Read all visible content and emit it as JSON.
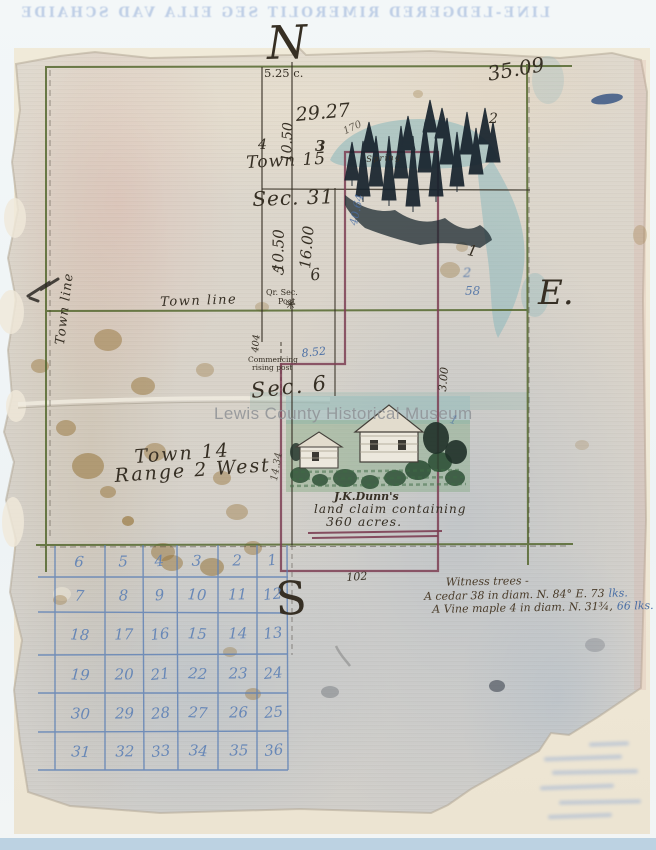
{
  "scan": {
    "watermark": "Lewis County Historical Museum",
    "bleedthrough_text": "LINE-LEDGERED RIMEROLIT SEG ELLA VAD SCHAIDE"
  },
  "colors": {
    "paper": "#d8d2c8",
    "township_line": "#55682f",
    "ink": "#362f24",
    "claim_line": "#7c3e53",
    "blue_annotation": "#4a6fa5",
    "grid_blue": "#5b7fb5",
    "watercolor": "#7fb3ba",
    "stain": "#96743a",
    "watermark": "#8f9296",
    "bleed_blue": "#8aa6d4",
    "backing": "#efe8d7"
  },
  "compass": {
    "north": "N",
    "east": "E.",
    "south": "S"
  },
  "labels": {
    "town_line_left": "Town line",
    "town_line_mid": "Town line",
    "town_15": "Town 15",
    "sec_31": "Sec. 31",
    "sec_6": "Sec. 6",
    "town_14": "Town 14",
    "range_2_west": "Range 2 West",
    "spring": "Spring",
    "qr_sec_line1": "Qr. Sec.",
    "qr_sec_line2": "Post",
    "commencing_line1": "Commencing",
    "commencing_line2": "rising post"
  },
  "icons": {
    "quarter_section_post": "✳"
  },
  "measurements": {
    "m5_25": "5.25 c.",
    "m29_27": "29.27",
    "m10_50_upper": "10.50",
    "m4": "4",
    "m3": "3",
    "m170": "170",
    "m35_09": "35.09",
    "m2_upper": "2",
    "m40_64": "40.64",
    "m10_50_lower": "10.50",
    "m5_lower": "5",
    "m16_00": "16.00",
    "m6": "6",
    "m404": "404",
    "m8_52": "8.52",
    "m3_00": "3.00",
    "m1_right": "1",
    "m2_blue": "2",
    "m58": "58",
    "m1_blue": "1",
    "m14_34": "14.34",
    "m102": "102"
  },
  "claim": {
    "owner": "J.K.Dunn's",
    "line2": "land claim containing",
    "line3": "360 acres."
  },
  "witness_notes": {
    "title": "Witness trees -",
    "entries": [
      {
        "main": "A cedar 38 in diam. N. 84° E. 73",
        "unit": "lks."
      },
      {
        "main": "A Vine maple 4 in diam. N. 31¾,",
        "unit": "66 lks."
      }
    ]
  },
  "section_grid": {
    "rows": [
      [
        6,
        5,
        4,
        3,
        2,
        1
      ],
      [
        7,
        8,
        9,
        10,
        11,
        12
      ],
      [
        18,
        17,
        16,
        15,
        14,
        13
      ],
      [
        19,
        20,
        21,
        22,
        23,
        24
      ],
      [
        30,
        29,
        28,
        27,
        26,
        25
      ],
      [
        31,
        32,
        33,
        34,
        35,
        36
      ]
    ]
  }
}
